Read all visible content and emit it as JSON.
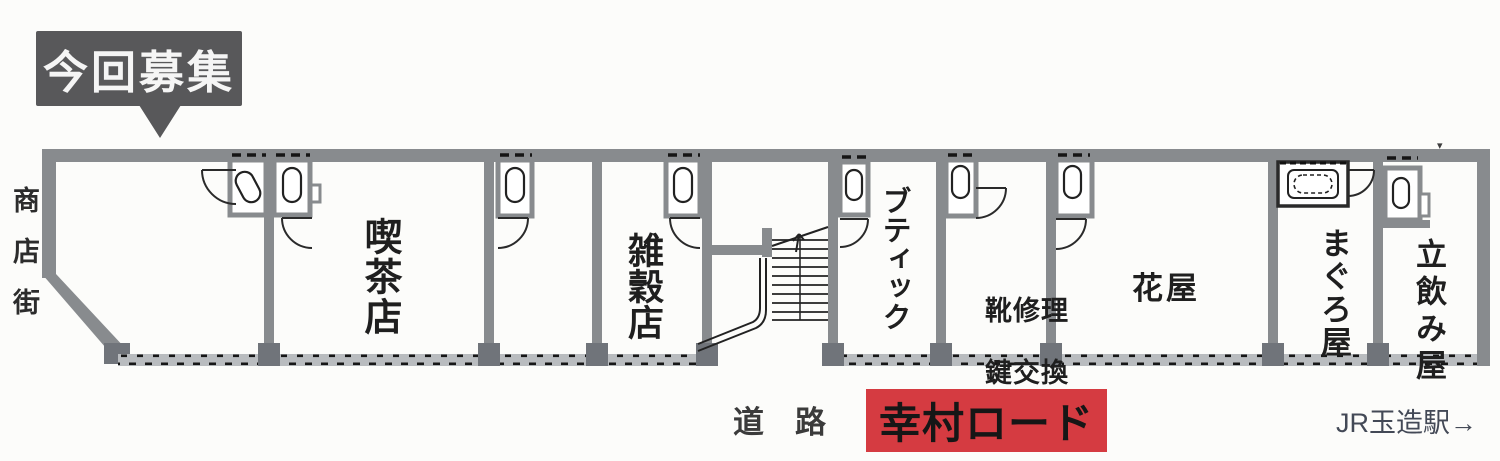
{
  "colors": {
    "wall_gray": "#888b8e",
    "pillar_gray": "#70747a",
    "callout_bg": "#58585a",
    "sign_red": "#d53b41",
    "line_black": "#222222"
  },
  "callout": {
    "label": "今回募集"
  },
  "side": {
    "street_label": "商店街"
  },
  "plan": {
    "units": [
      {
        "label": "喫茶店"
      },
      {
        "label": "雑穀店"
      },
      {
        "label": "ブティック"
      },
      {
        "label": "靴修理",
        "label2": "鍵交換"
      },
      {
        "label": "花屋"
      },
      {
        "label": "まぐろ屋"
      },
      {
        "label": "立飲み屋"
      }
    ],
    "marker": "▾"
  },
  "bottom": {
    "road_label": "道　路",
    "sign_label": "幸村ロード",
    "station_label": "JR玉造駅→"
  }
}
